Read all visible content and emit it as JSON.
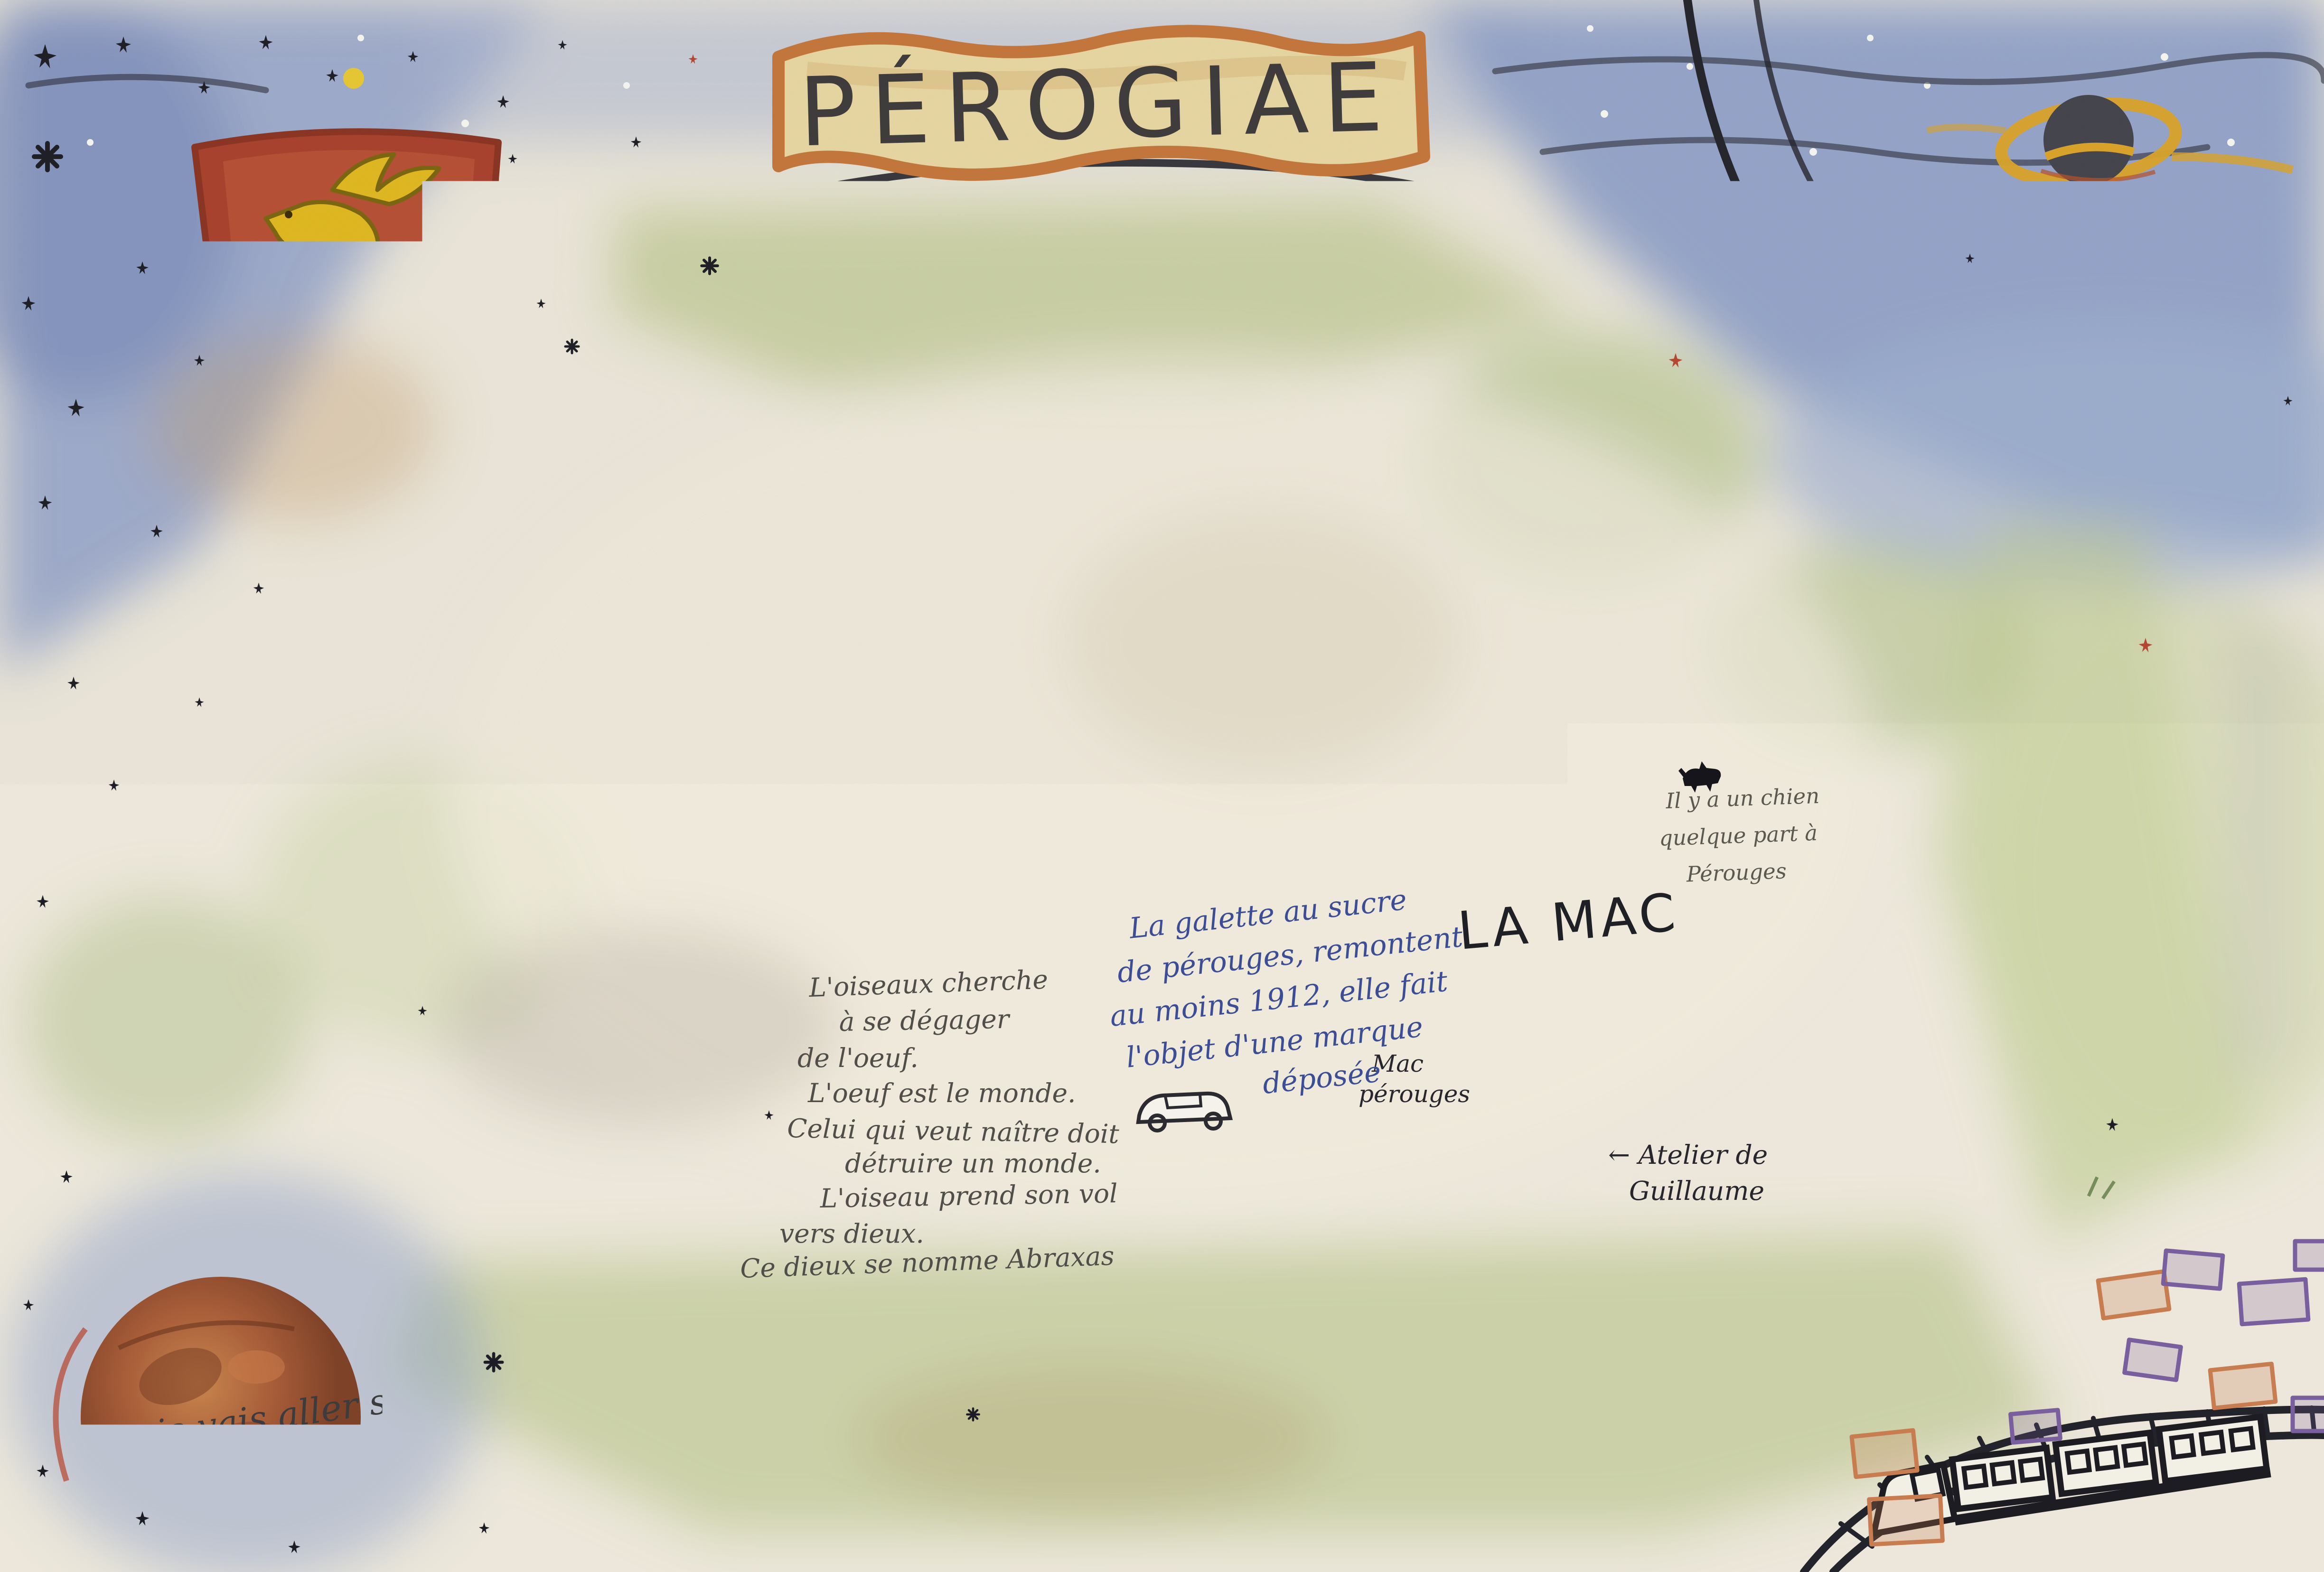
{
  "artwork": {
    "title": "PÉROGIAE"
  },
  "labels": {
    "ghost": {
      "lines": [
        "LE JEUNE",
        "FANTÔME"
      ]
    },
    "atelier_clairiere": "Atelier Clairière",
    "la_mac": "LA MAC",
    "mac_perouges": {
      "lines": [
        "Mac",
        "pérouges"
      ]
    },
    "atelier_guillaume": {
      "lines": [
        "← Atelier de",
        "Guillaume"
      ]
    },
    "dog_note": {
      "lines": [
        "Il y a un chien",
        "quelque part à",
        "Pérouges"
      ]
    },
    "galette_note": {
      "lines": [
        "La galette au sucre",
        "de pérouges, remontent",
        "au moins 1912, elle fait",
        "l'objet d'une marque",
        "déposée"
      ]
    },
    "demian_quote": {
      "lines": [
        "L'oiseaux cherche",
        "à se dégager",
        "de l'oeuf.",
        "L'oeuf est le monde.",
        "Celui qui veut naître doit",
        "détruire un monde.",
        "L'oiseau prend son vol",
        "vers dieux.",
        "Ce dieux se nomme Abraxas"
      ]
    },
    "mars_note": {
      "lines": [
        "je vais aller sur Mars",
        "avec Tania ce soir."
      ]
    },
    "station_sign": {
      "lines": [
        "Meximieux",
        "-pérouges"
      ]
    }
  },
  "figures": {
    "shield": "dragon-coat-of-arms-shield",
    "banner": "title-banner",
    "ghost": "flying-ghost",
    "black_hole": "black-hole-with-orange-ring",
    "mars": "planet-mars",
    "pumpkins": "two-jack-o-lanterns-one-with-witch-hat",
    "galette": "sugar-galette-on-baker-peel",
    "big_tree": "central-tree-on-cobblestones",
    "woman": "medieval-woman-with-basket",
    "dog": "small-black-dog",
    "train": "train-on-curved-track",
    "car": "small-car"
  },
  "colors": {
    "canvas": "#ece7da",
    "ink": "#26262c",
    "pencil": "#4f4e49",
    "blue_ink": "#3b4d94",
    "navy_text": "#2c3a6e",
    "banner_fill": "#e8d7a2",
    "banner_border": "#c4763b",
    "shield_red": "#a8402c",
    "dragon_gold": "#e0b81f",
    "sky_blue": "#8fa0c8",
    "meadow_green": "#b5c287",
    "pine_green": "#45663a",
    "roof_red": "#b5624a",
    "pumpkin_orange": "#cc6f2e",
    "witch_hat_blue": "#3c4f8e",
    "galette_tan": "#d9a452",
    "mars_brown": "#a65c38",
    "black_hole_ring": "#dba428"
  }
}
